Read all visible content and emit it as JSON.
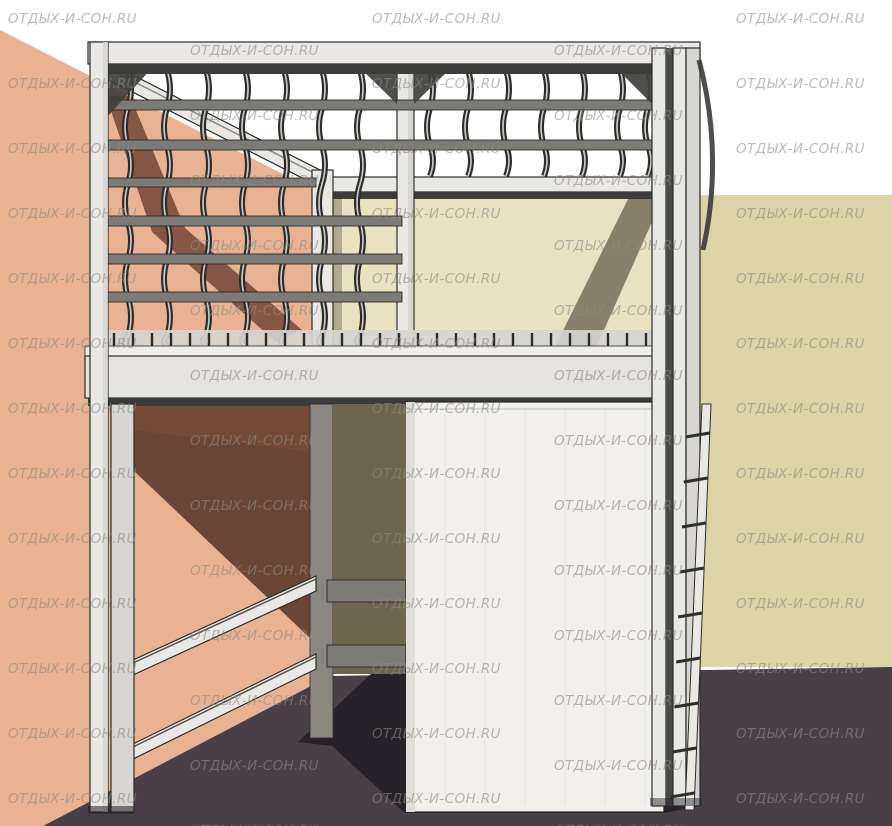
{
  "watermark": {
    "text": "ОТДЫХ-И-СОН.RU",
    "color": "#8e8a84",
    "opacity": 0.58
  },
  "scene": {
    "subject": "corner loft bed frame with curved slatted base, wardrobe panel, shelf column, guard rails and ladder",
    "colors": {
      "background": "#ffffff",
      "wall_left": "#e8b293",
      "wall_left_shadow": "#7c4e3c",
      "wall_left_shadow_deep": "#6b4536",
      "wall_right": "#dcd4a7",
      "wall_right_light": "#e9e2c1",
      "wall_right_shadow": "#6e6752",
      "floor": "#483f47",
      "floor_shadow": "#272129",
      "frame_light": "#e9e8e5",
      "frame_mid": "#d6d5d1",
      "frame_dark": "#2b2b29",
      "rail_gray": "#7c7b75",
      "rail_dark": "#3c3c3a",
      "slat_dark": "#2c2c2a",
      "slat_highlight": "#c9c8c4",
      "post_shadow": "#8a8781",
      "shelf_olive": "#6d6550",
      "shelf_bar": "#7e7c76",
      "gap_dark": "#4a453e",
      "wardrobe": "#f1f0ec",
      "wardrobe_grain": "#e4e3df"
    }
  }
}
